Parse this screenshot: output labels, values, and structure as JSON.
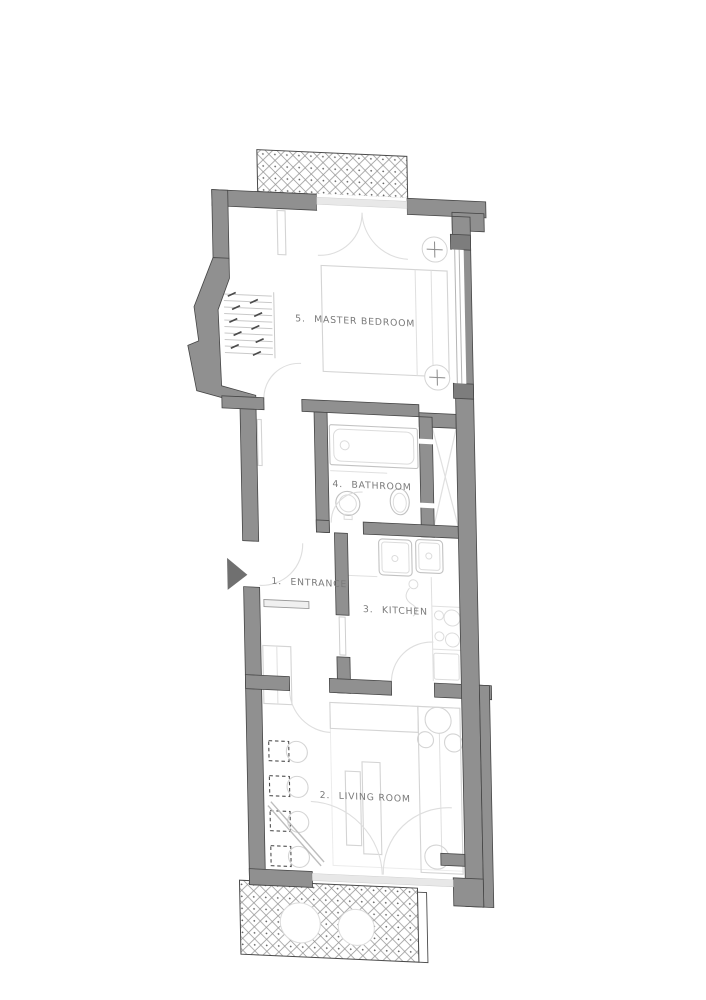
{
  "plan": {
    "type": "apartment floor plan",
    "rooms": [
      {
        "number": "1.",
        "name": "ENTRANCE"
      },
      {
        "number": "2.",
        "name": "LIVING ROOM"
      },
      {
        "number": "3.",
        "name": "KITCHEN"
      },
      {
        "number": "4.",
        "name": "BATHROOM"
      },
      {
        "number": "5.",
        "name": "MASTER BEDROOM"
      }
    ],
    "colors": {
      "background": "#ffffff",
      "wall_fill": "#909090",
      "wall_outline": "#454545",
      "furniture_line": "#d4d4d4",
      "fixture_line": "#c2c2c2",
      "hatch_line": "#979797",
      "label_text": "#7a7a7a",
      "entry_marker": "#707070"
    },
    "icons": [
      {
        "name": "entry-arrow-icon",
        "meaning": "apartment entry direction marker"
      },
      {
        "name": "cross-circle-icon",
        "meaning": "column / heating point symbol in bedroom"
      },
      {
        "name": "shaft-x-icon",
        "meaning": "crossed shaft / wardrobe niche"
      }
    ],
    "features": [
      "hatched balcony top",
      "hatched balcony bottom",
      "radiator bay",
      "window on right wall"
    ]
  }
}
